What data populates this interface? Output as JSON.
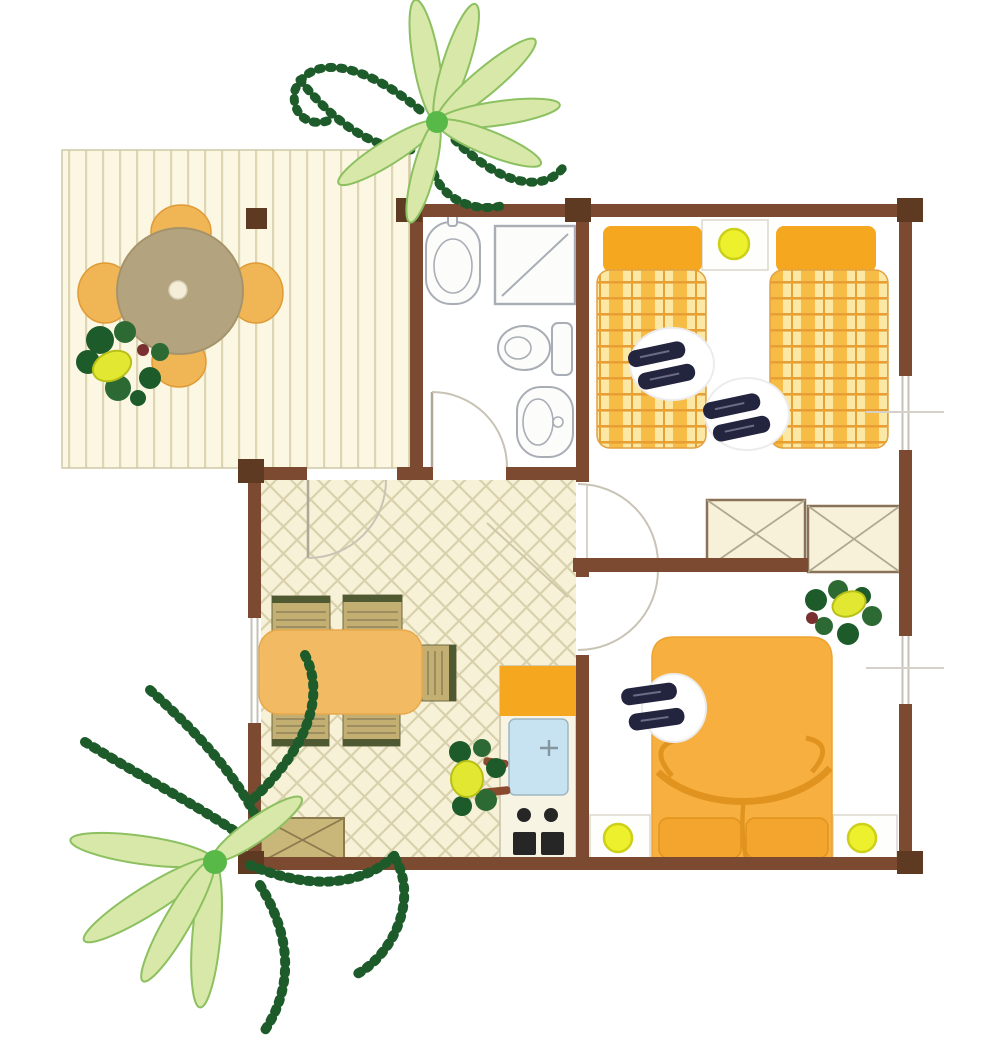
{
  "diagram_type": "bungalow-floor-plan",
  "visible_text": [],
  "colors": {
    "wall": "#7C4A31",
    "post": "#5E3A23",
    "deck-bg": "#FBF7E2",
    "deck-stripe": "#DED6B2",
    "floor": "#F6F1D7",
    "lattice-line": "#D9D1AC",
    "table-round": "#B3A37E",
    "table-dot": "#F4EED8",
    "deck-chair": "#F0B656",
    "deck-chair-edge": "#E09A35",
    "orange": "#F5A81F",
    "bed-orange": "#F7B040",
    "bed-orange-deep": "#E0941F",
    "plaid-bg": "#FBE8A4",
    "plaid-band": "#F6BC45",
    "plaid-line": "#E89F33",
    "wood-table": "#F1BA63",
    "wood-table-edge": "#E8A94A",
    "chair-tan": "#C3AF72",
    "chair-dark": "#4F5A33",
    "chair-line": "#8F835A",
    "lamp": "#EDF02C",
    "lamp-ring": "#CDD018",
    "wardrobe-bg": "#F7F1DA",
    "wardrobe-border": "#8A7258",
    "x-line": "#B0A890",
    "sink-blue": "#C7E3F2",
    "fixture": "#A9AEB6",
    "fixture-fill": "#FCFCFA",
    "door-line": "#C9C3B5",
    "window-line": "#C6C0B6",
    "plant-dark": "#2D6A33",
    "plant-darker": "#1E5B2A",
    "plant-light": "#D8E8A8",
    "plant-mid": "#8CC060",
    "plant-bright": "#58B848",
    "plant-yellow": "#E2E832",
    "plant-yellow-edge": "#B8C018",
    "accent-red": "#7A3030",
    "slipper": "#23243E",
    "slipper-hi": "#6B6B85",
    "mat": "#FFFFFF",
    "stove-dark": "#262626",
    "counter-bg": "#F8F4E4",
    "counter-border": "#C8C1A6",
    "nightstand-border": "#DCD7CC",
    "cabinet": "#C9B77A",
    "cabinet-edge": "#8A7A4E",
    "white": "#FEFEFD"
  },
  "legend": {
    "areas": [
      "deck-terrace",
      "bathroom",
      "bedroom-twin",
      "wardrobe-corridor",
      "living-dining-room",
      "kitchen-corner",
      "bedroom-double"
    ],
    "objects": [
      "round-patio-table",
      "patio-chair",
      "deck-post",
      "potted-plant",
      "washbasin",
      "shower",
      "toilet",
      "bidet",
      "single-bed",
      "double-bed",
      "nightstand-lamp",
      "slippers",
      "wardrobe",
      "dining-table",
      "dining-chair",
      "sideboard-cabinet",
      "kitchen-sink",
      "stove-burners",
      "door-swing",
      "window",
      "palm-plant"
    ]
  },
  "counts": {
    "single-beds": 2,
    "double-beds": 1,
    "doors": 4,
    "windows": 3,
    "wardrobes": 2,
    "lamps": 3
  }
}
